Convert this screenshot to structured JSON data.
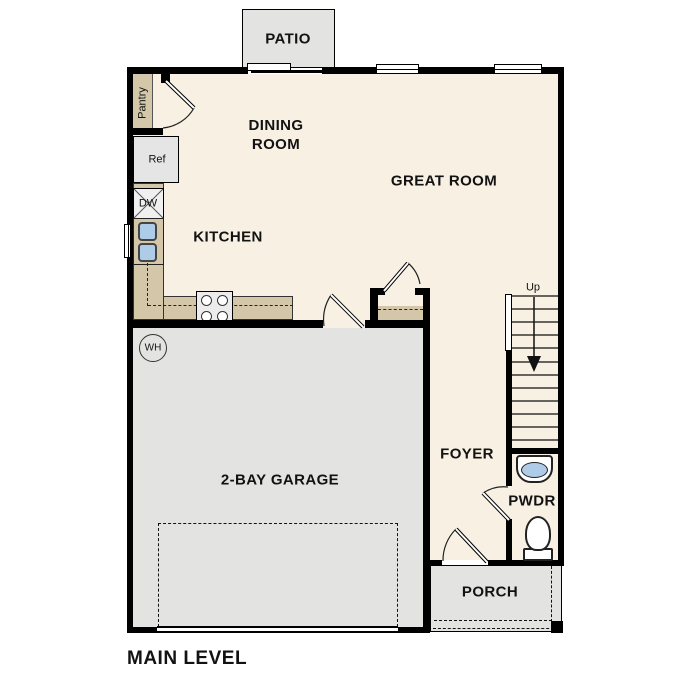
{
  "plan_title": "MAIN LEVEL",
  "rooms": {
    "patio": {
      "label": "PATIO"
    },
    "dining": {
      "label": "DINING ROOM"
    },
    "great": {
      "label": "GREAT ROOM"
    },
    "kitchen": {
      "label": "KITCHEN"
    },
    "garage": {
      "label": "2-BAY GARAGE"
    },
    "foyer": {
      "label": "FOYER"
    },
    "pwdr": {
      "label": "PWDR"
    },
    "porch": {
      "label": "PORCH"
    }
  },
  "fixtures": {
    "pantry": "Pantry",
    "refrigerator": "Ref",
    "dishwasher": "DW",
    "water_heater": "WH",
    "stairs_direction": "Up"
  },
  "colors": {
    "floor": "#f7f0e3",
    "hardscape": "#e3e3e1",
    "counter": "#d3c6a9",
    "appliance": "#e5e5e5",
    "sink": "#aecbe8",
    "wall": "#000000"
  }
}
